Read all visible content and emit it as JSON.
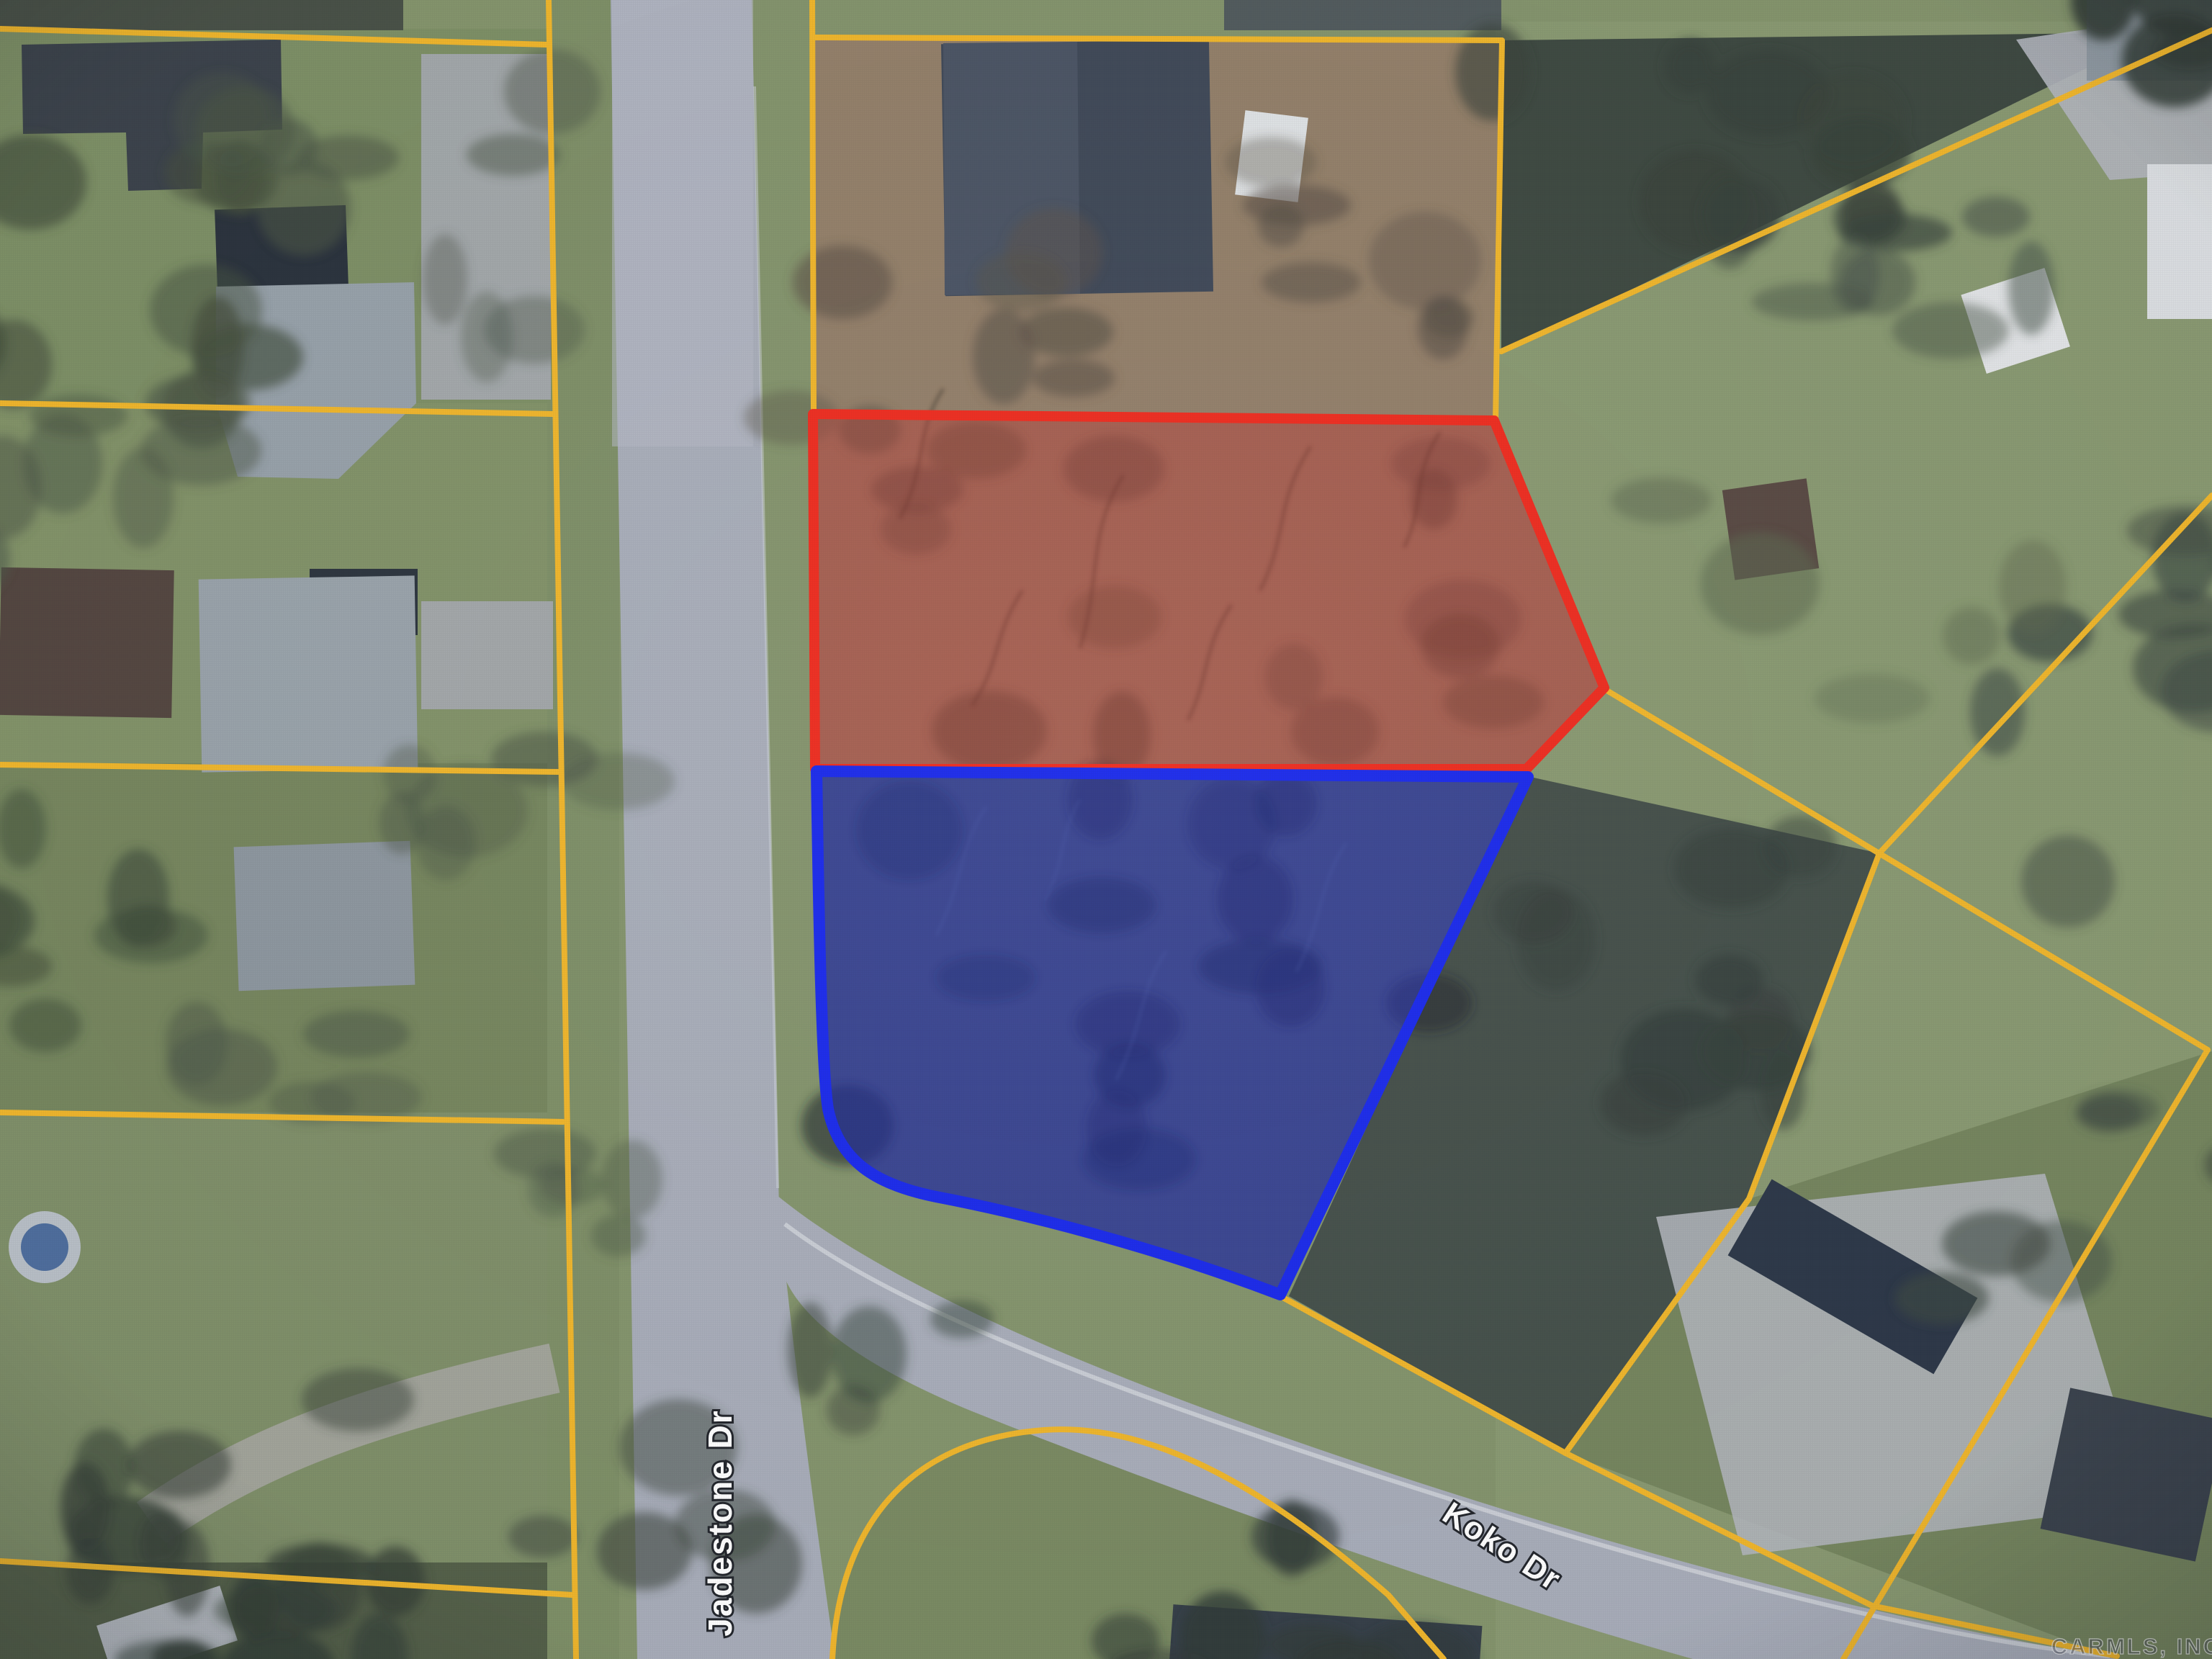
{
  "map": {
    "streets": {
      "jadestone": "Jadestone Dr",
      "koko": "Koko Dr"
    },
    "watermark": "CARMLS, INC",
    "colors": {
      "parcel_boundary": "#f0b62c",
      "subject_outline_red": "#ee2d20",
      "subject_fill_red": "rgba(224,62,52,0.32)",
      "subject_outline_blue": "#1c2beb",
      "subject_fill_blue": "rgba(38,52,208,0.45)",
      "road": "#a9aeba",
      "label_text": "#ffffff"
    }
  }
}
